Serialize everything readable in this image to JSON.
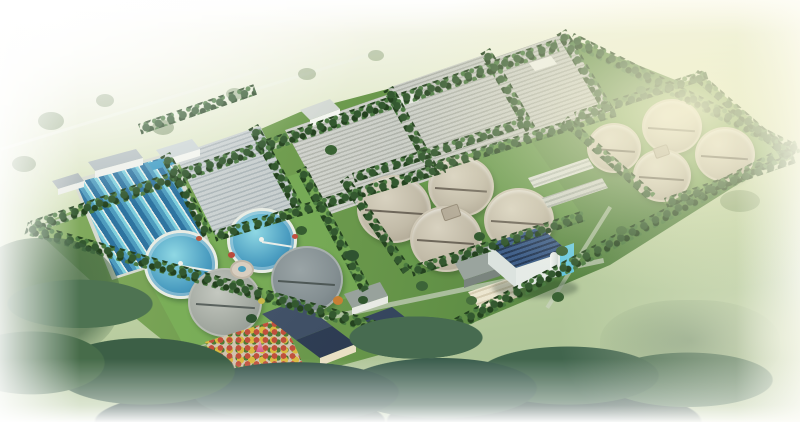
{
  "scene": {
    "type": "3D aerial rendering",
    "subject": "Wastewater treatment plant master plan, bird's-eye isometric view",
    "setting": "Rectangular plant site ringed by tree belts and roads, set in pale hazy fields that fade to white at the image edges, dark tree masses in the foreground",
    "no_visible_text": true
  },
  "palette": {
    "haze_white": "#ffffff",
    "field_green": "#c2d4a8",
    "site_lawn_green": "#6d9a52",
    "tree_dark_green": "#2e4d2f",
    "forest_teal": "#35544a",
    "basin_concrete": "#c6c8c0",
    "water_blue": "#4a9cc0",
    "clarifier_tan": "#c2bba9",
    "roof_dark_blue": "#2c4058",
    "accent_cyan": "#45c0dc",
    "building_white": "#f2f4f0",
    "warm_glow": "#f8f2d0"
  },
  "facility": {
    "sedimentation_basins": {
      "label": "rectangular sedimentation basins with blue water lanes",
      "lanes": 6,
      "water_color": "#4a9cc0"
    },
    "aeration_basins": {
      "label": "large striped aeration basin blocks",
      "count": 4
    },
    "clarifiers_water": {
      "label": "circular clarifiers filled with water",
      "count": 2
    },
    "clarifiers_concrete_sw": {
      "label": "concrete circular tanks, south-west group",
      "count": 2
    },
    "clarifiers_center_group": {
      "label": "concrete clarifier group, center",
      "count": 4
    },
    "clarifiers_northeast_group": {
      "label": "concrete clarifier group, north-east",
      "count": 4
    },
    "office_building": {
      "label": "main office building with dark solar-panel roof and cyan stair tower",
      "floors": 3
    },
    "admin_complex": {
      "label": "administration buildings with dark hip roofs and cream walls"
    },
    "garden": {
      "label": "ornamental garden with colorful flower beds and red sculpture"
    },
    "fountain": {
      "label": "small circular fountain plaza"
    },
    "workshops": {
      "label": "auxiliary workshop and shed buildings",
      "count": 10
    },
    "tree_belt": {
      "label": "perimeter tree belt along boundary roads"
    },
    "forest_foreground": {
      "label": "dense foreground tree mass fading to white"
    }
  }
}
